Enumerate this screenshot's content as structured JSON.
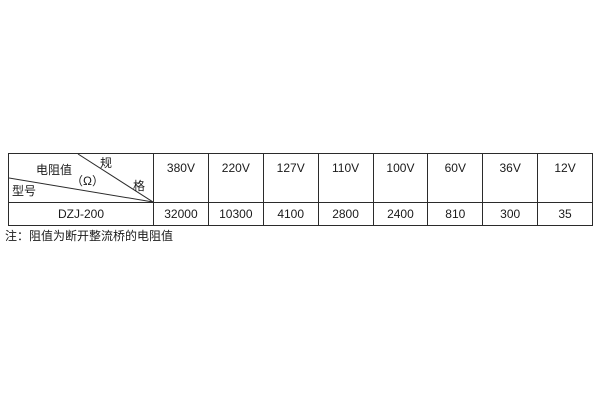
{
  "table": {
    "corner": {
      "spec_top": "规",
      "spec_right": "格",
      "resistance": "电阻值",
      "unit": "（Ω）",
      "model": "型号"
    },
    "row_model": "DZJ-200",
    "columns": [
      {
        "voltage": "380V",
        "value": "32000"
      },
      {
        "voltage": "220V",
        "value": "10300"
      },
      {
        "voltage": "127V",
        "value": "4100"
      },
      {
        "voltage": "110V",
        "value": "2800"
      },
      {
        "voltage": "100V",
        "value": "2400"
      },
      {
        "voltage": "60V",
        "value": "810"
      },
      {
        "voltage": "36V",
        "value": "300"
      },
      {
        "voltage": "12V",
        "value": "35"
      }
    ]
  },
  "note": "注：阻值为断开整流桥的电阻值",
  "colors": {
    "border": "#2b2b2b",
    "text": "#1a1a1a",
    "background": "#ffffff"
  }
}
